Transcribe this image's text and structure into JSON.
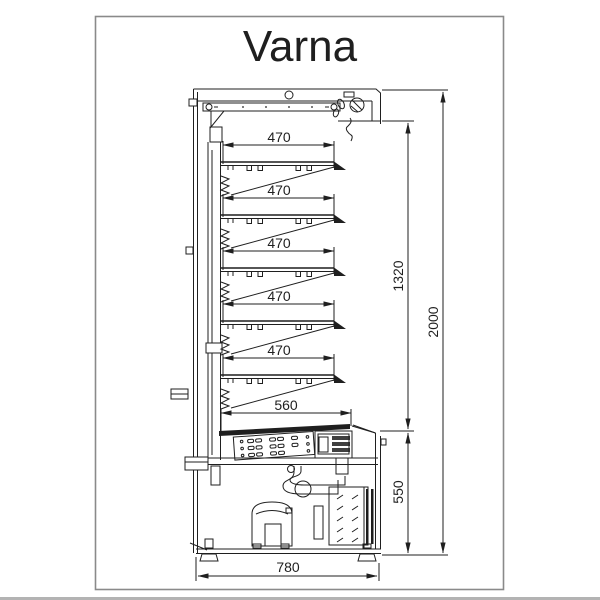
{
  "title": "Varna",
  "drawing_type": "refrigerated multideck cabinet - side section",
  "dimensions": {
    "shelves": [
      "470",
      "470",
      "470",
      "470",
      "470"
    ],
    "bottom_shelf": "560",
    "overall_depth": "780",
    "opening_height": "1320",
    "overall_height": "2000",
    "base_height": "550"
  },
  "colors": {
    "line": "#1f1f1f",
    "frame": "#8a8a8a",
    "background": "#ffffff"
  }
}
